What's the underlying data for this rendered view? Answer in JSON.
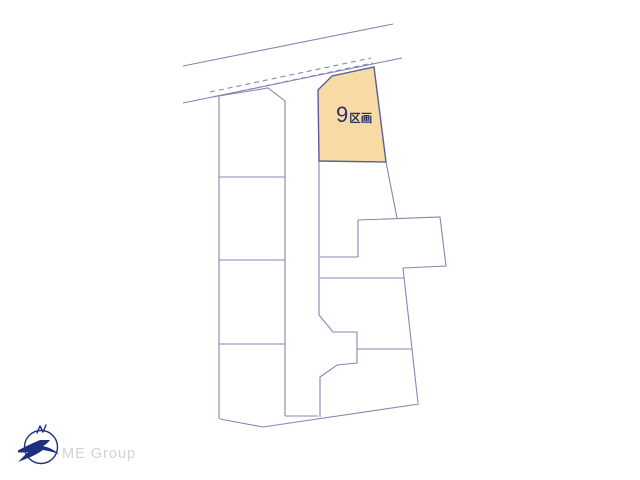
{
  "diagram": {
    "highlight_lot": {
      "number": "9",
      "suffix": "区画"
    },
    "colors": {
      "line": "#8487b2",
      "highlight_fill": "#f8dba4",
      "highlight_stroke": "#5a5d9c",
      "label": "#2d3166"
    },
    "highlight_polygon": "318,90 332,76 374,67 386,162 319,161",
    "solid_lines": [
      "183,66 393,24",
      "183,103 402,58",
      "219,96 268,88 285,101 285,416",
      "219,96 219,419",
      "219,177 285,177",
      "219,260 285,260",
      "219,344 285,344",
      "220,419 263,427 419,404",
      "285,416 318,416",
      "319,161 319,315 333,332 357,332 357,363 337,365 320,377 320,417",
      "386,162 397,218",
      "358,220 440,217 446,266 403,268",
      "358,220 358,257",
      "320,257 358,257",
      "320,278 404,278",
      "357,349 412,349",
      "403,268 418,403"
    ],
    "dashed_lines": [
      "210,92 371,58",
      "213,97 373,63"
    ]
  },
  "footer": {
    "brand": "ME Group",
    "brand_color": "#d2d2d2",
    "logo_color": "#1d2f7e"
  }
}
